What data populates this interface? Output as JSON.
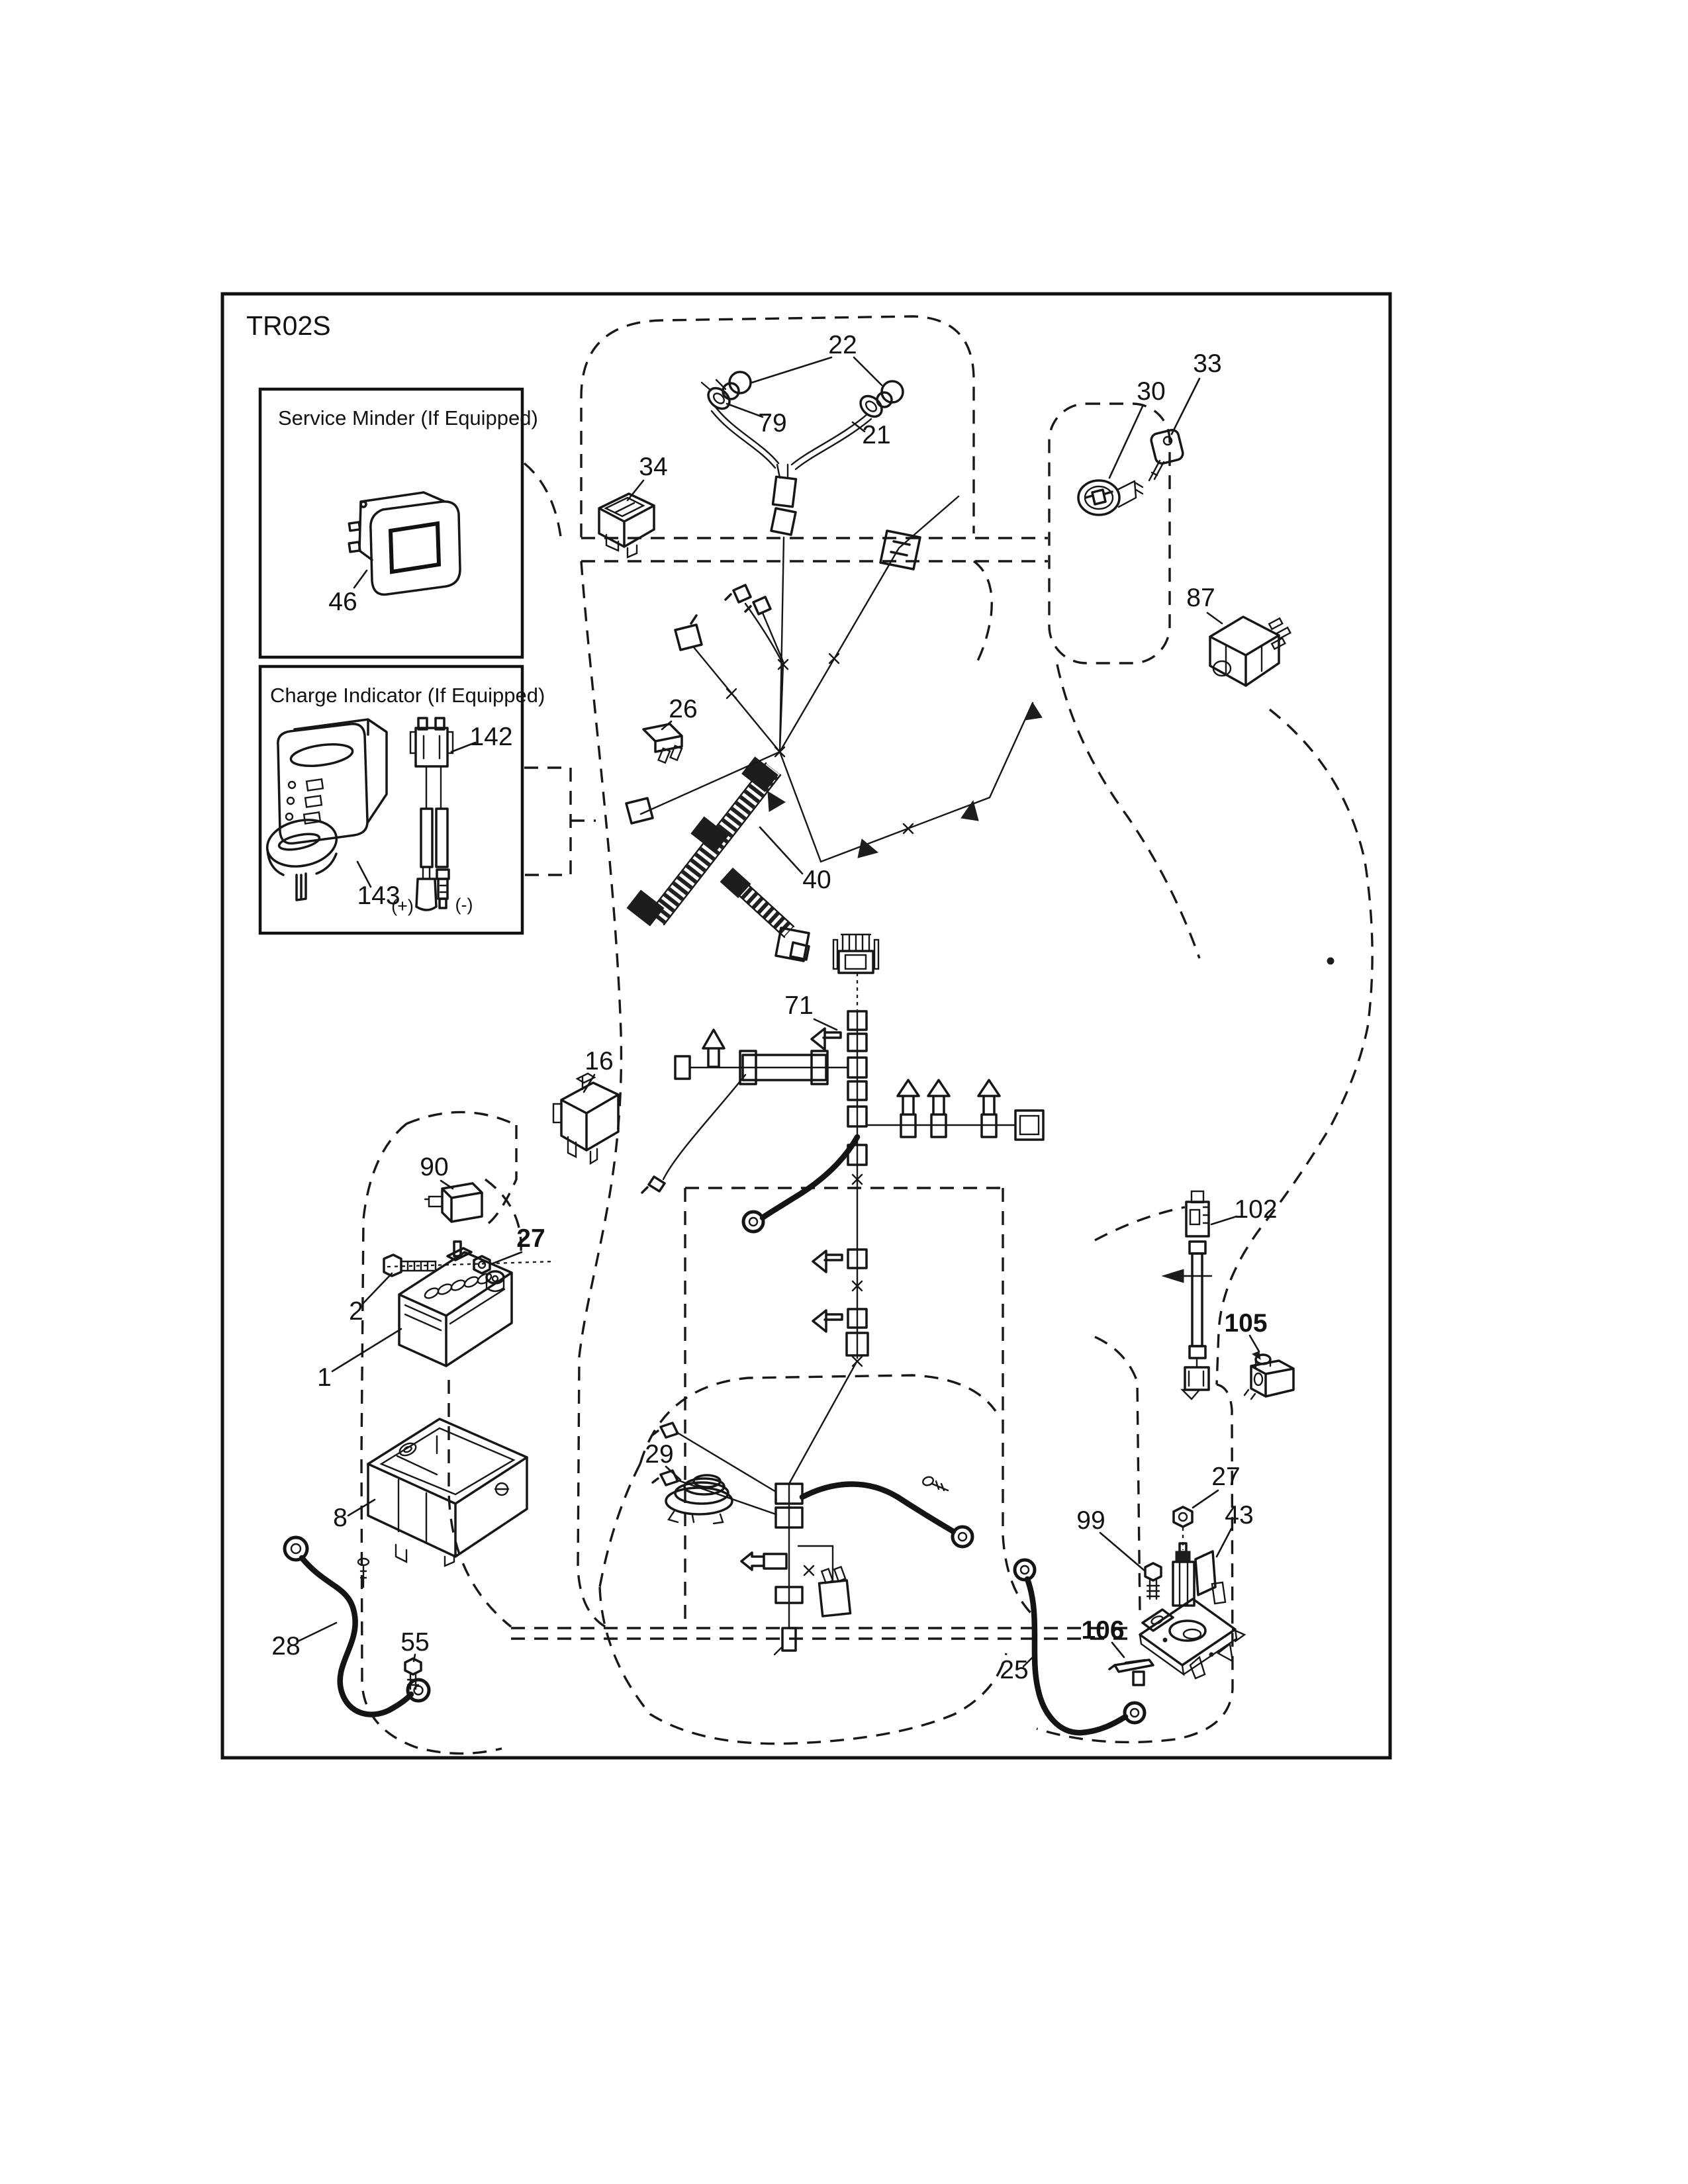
{
  "diagram": {
    "code": "TR02S"
  },
  "inset_service": {
    "title": "Service Minder (If Equipped)"
  },
  "inset_charge": {
    "title": "Charge Indicator (If Equipped)",
    "pos": "(+)",
    "neg": "(-)"
  },
  "callouts": {
    "n22": "22",
    "n79": "79",
    "n21": "21",
    "n34": "34",
    "n30": "30",
    "n33": "33",
    "n87": "87",
    "n46": "46",
    "n26": "26",
    "n142": "142",
    "n143": "143",
    "n40": "40",
    "n71": "71",
    "n16": "16",
    "n90": "90",
    "n27a": "27",
    "n2": "2",
    "n1": "1",
    "n8": "8",
    "n28": "28",
    "n55": "55",
    "n29": "29",
    "n102": "102",
    "n105": "105",
    "n99": "99",
    "n27b": "27",
    "n43": "43",
    "n106": "106",
    "n25": "25"
  }
}
